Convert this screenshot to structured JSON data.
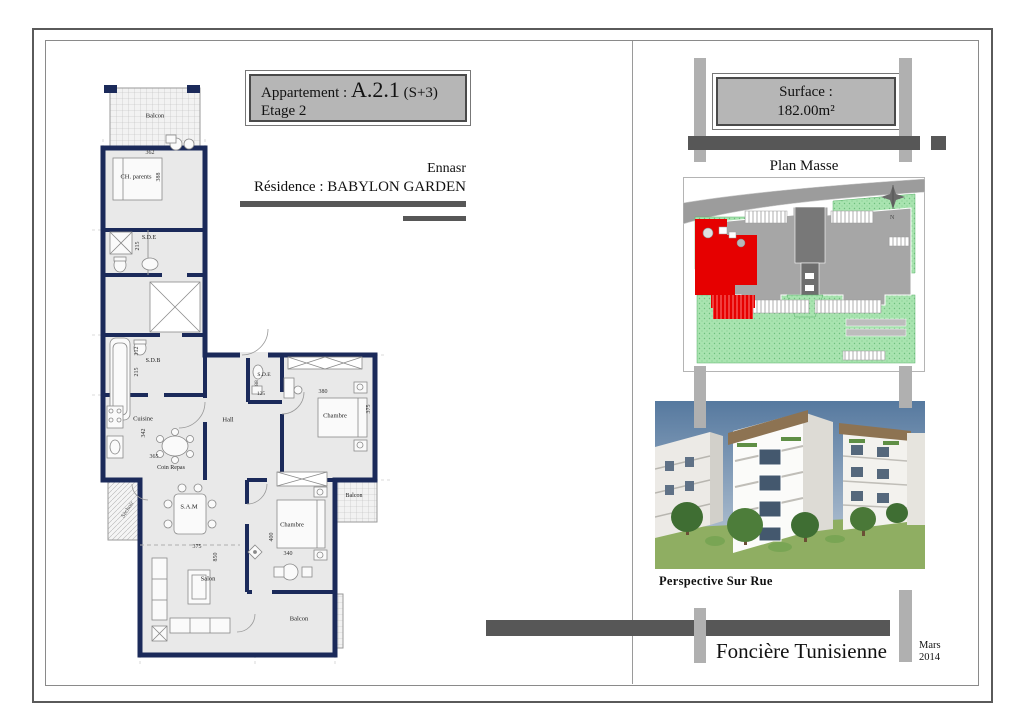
{
  "page": {
    "title_box": {
      "label": "Appartement :",
      "value": "A.2.1",
      "suffix": "(S+3)",
      "etage": "Etage 2"
    },
    "location": "Ennasr",
    "residence": "Résidence : BABYLON GARDEN",
    "surface_box": {
      "label": "Surface :",
      "value": "182.00m²"
    },
    "plan_masse_title": "Plan Masse",
    "compass": "N",
    "perspective_caption": "Perspective Sur Rue",
    "company": "Foncière Tunisienne",
    "date_month": "Mars",
    "date_year": "2014"
  },
  "floorplan": {
    "rooms": {
      "balcon_top": "Balcon",
      "ch_parents": "CH. parents",
      "sde1": "S.D.E",
      "sdb": "S.D.B",
      "cuisine": "Cuisine",
      "coin_repas": "Coin Repas",
      "sechoir": "Sèchoir",
      "hall": "Hall",
      "sde2": "S.D.E",
      "chambre1": "Chambre",
      "balcon_right": "Balcon",
      "sam": "S.A.M",
      "salon": "Salon",
      "chambre2": "Chambre",
      "balcon_bottom": "Balcon"
    },
    "dims": {
      "d362": "362",
      "d388": "388",
      "d215a": "215",
      "d312": "312",
      "d215b": "215",
      "d342": "342",
      "d365": "365",
      "d88": "88",
      "d125": "125",
      "d380": "380",
      "d375a": "375",
      "d375b": "375",
      "d850": "850",
      "d340": "340",
      "d400": "400"
    }
  },
  "colors": {
    "wall_navy": "#1b2a5a",
    "box_gray": "#b6b6b6",
    "bar_dark": "#575757",
    "bar_light": "#b0b0b0",
    "unit_red": "#e60000",
    "lawn_green": "#a9e4b0"
  }
}
